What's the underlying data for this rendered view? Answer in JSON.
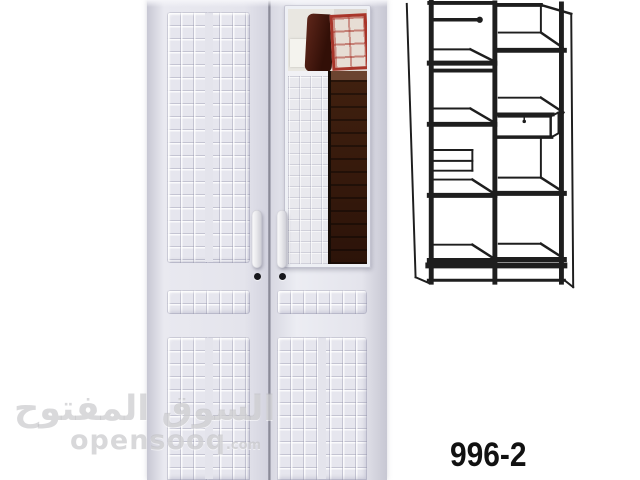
{
  "product": {
    "model_number": "996-2"
  },
  "watermark": {
    "arabic_text": "السوق المفتوح",
    "site_name": "opensooq",
    "site_tld": ".com"
  },
  "colors": {
    "background": "#ffffff",
    "wardrobe_body": "#e4e4ec",
    "mirror_wood_brown": "#3c1f12",
    "mirror_box_red": "#a8352a",
    "diagram_line": "#1e1e1e",
    "model_text": "#111111",
    "watermark_gray": "#bababa"
  }
}
